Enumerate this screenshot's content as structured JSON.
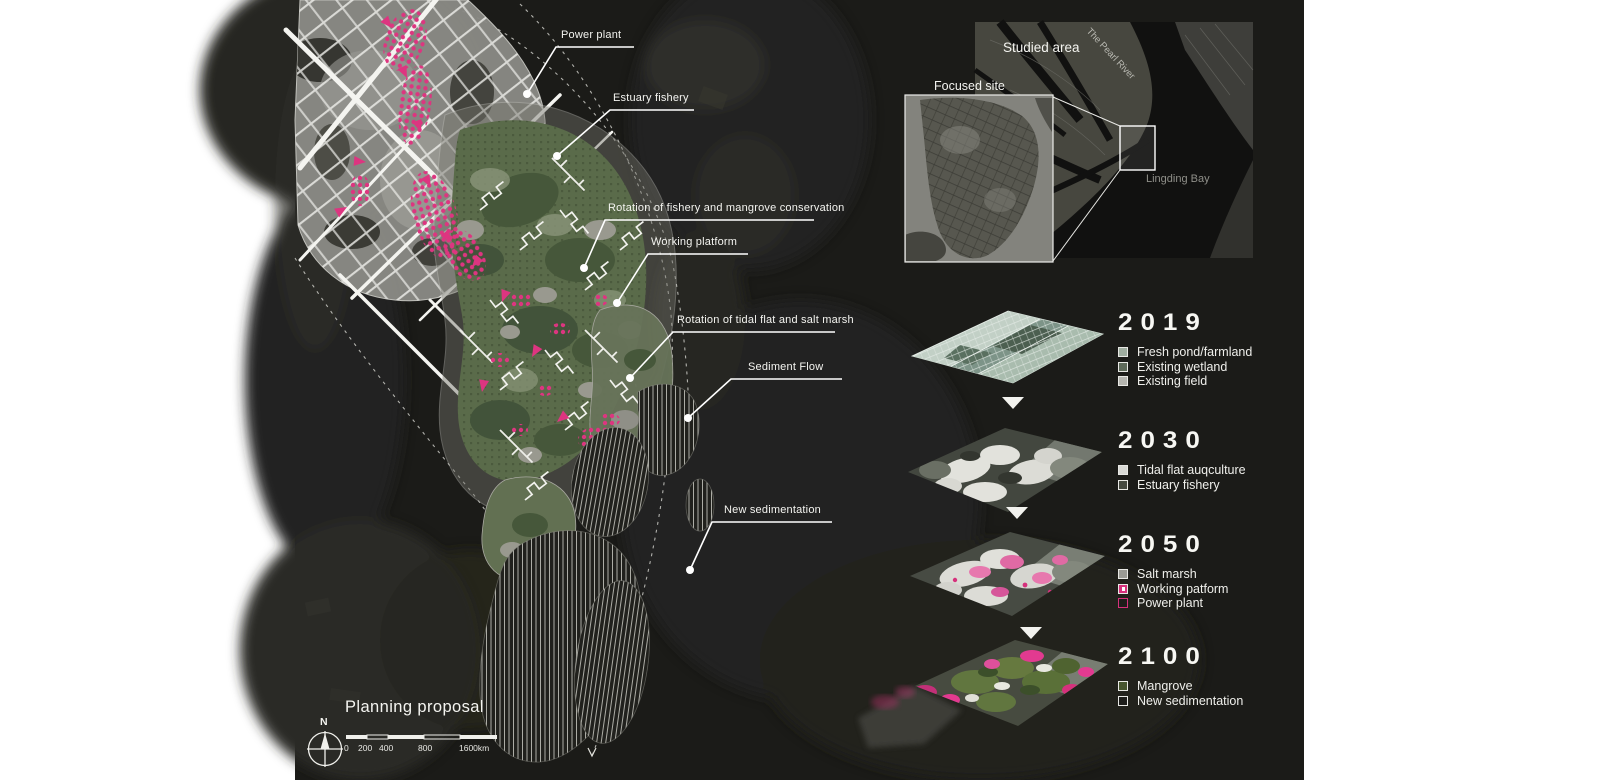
{
  "main_map": {
    "title": "Planning proposal",
    "compass_label": "N",
    "scale_labels": [
      "0",
      "200",
      "400",
      "800",
      "1600km"
    ],
    "callouts": [
      {
        "label": "Power plant"
      },
      {
        "label": "Estuary fishery"
      },
      {
        "label": "Rotation of fishery and mangrove conservation"
      },
      {
        "label": "Working platform"
      },
      {
        "label": "Rotation of tidal flat and salt marsh"
      },
      {
        "label": "Sediment Flow"
      },
      {
        "label": "New sedimentation"
      }
    ]
  },
  "inset": {
    "studied_area_label": "Studied area",
    "river_label": "The Pearl River",
    "bay_label": "Lingding Bay",
    "focused_site_label": "Focused site"
  },
  "timeline": {
    "phases": [
      {
        "year": "2019",
        "legend": [
          {
            "label": "Fresh pond/farmland",
            "fill": "#9fad9f",
            "border": "#e8e8e4"
          },
          {
            "label": "Existing wetland",
            "fill": "#5e6a5a",
            "border": "#e8e8e4"
          },
          {
            "label": "Existing field",
            "fill": "#b5b5af",
            "border": "#e8e8e4"
          }
        ]
      },
      {
        "year": "2030",
        "legend": [
          {
            "label": "Tidal flat auqculture",
            "fill": "#d9d9d4",
            "border": "#e8e8e4"
          },
          {
            "label": "Estuary fishery",
            "fill": "#45493f",
            "border": "#e8e8e4"
          }
        ]
      },
      {
        "year": "2050",
        "legend": [
          {
            "label": "Salt marsh",
            "fill": "#9b9b95",
            "border": "#e8e8e4"
          },
          {
            "label": "Working patform",
            "fill": "#d6317c",
            "border": "#e8e8e4"
          },
          {
            "label": "Power plant",
            "fill": "#1d1d1a",
            "border": "#d6317c"
          }
        ]
      },
      {
        "year": "2100",
        "legend": [
          {
            "label": "Mangrove",
            "fill": "#47552e",
            "border": "#e8e8e4"
          },
          {
            "label": "New sedimentation",
            "fill": "#1d1d1a",
            "border": "#e8e8e4"
          }
        ]
      }
    ]
  },
  "colors": {
    "accent_pink": "#dd3580",
    "panel_bg": "#1b1b18"
  }
}
